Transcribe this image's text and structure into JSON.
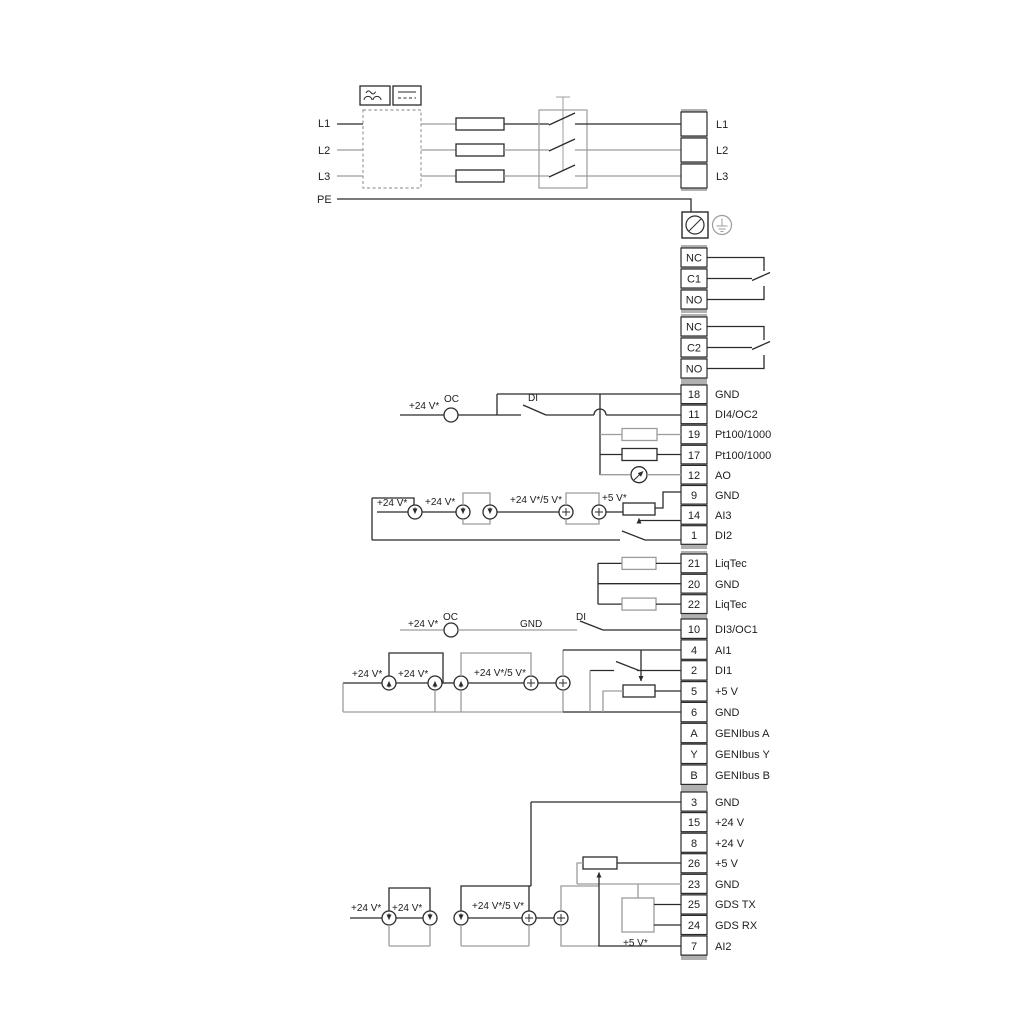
{
  "colors": {
    "wire_black": "#2b2b2b",
    "wire_gray": "#9c9c9c"
  },
  "power": {
    "inputs": [
      "L1",
      "L2",
      "L3"
    ],
    "pe": "PE",
    "outputs": [
      "L1",
      "L2",
      "L3"
    ]
  },
  "relay1": {
    "terminals": [
      "NC",
      "C1",
      "NO"
    ]
  },
  "relay2": {
    "terminals": [
      "NC",
      "C2",
      "NO"
    ]
  },
  "io1": {
    "terminals": [
      {
        "pin": "18",
        "label": "GND"
      },
      {
        "pin": "11",
        "label": "DI4/OC2"
      },
      {
        "pin": "19",
        "label": "Pt100/1000"
      },
      {
        "pin": "17",
        "label": "Pt100/1000"
      },
      {
        "pin": "12",
        "label": "AO"
      },
      {
        "pin": "9",
        "label": "GND"
      },
      {
        "pin": "14",
        "label": "AI3"
      },
      {
        "pin": "1",
        "label": "DI2"
      }
    ]
  },
  "io2": {
    "terminals": [
      {
        "pin": "21",
        "label": "LiqTec"
      },
      {
        "pin": "20",
        "label": "GND"
      },
      {
        "pin": "22",
        "label": "LiqTec"
      }
    ]
  },
  "io3": {
    "terminals": [
      {
        "pin": "10",
        "label": "DI3/OC1"
      },
      {
        "pin": "4",
        "label": "AI1"
      },
      {
        "pin": "2",
        "label": "DI1"
      },
      {
        "pin": "5",
        "label": "+5 V"
      },
      {
        "pin": "6",
        "label": "GND"
      },
      {
        "pin": "A",
        "label": "GENIbus A"
      },
      {
        "pin": "Y",
        "label": "GENIbus Y"
      },
      {
        "pin": "B",
        "label": "GENIbus B"
      }
    ]
  },
  "io4": {
    "terminals": [
      {
        "pin": "3",
        "label": "GND"
      },
      {
        "pin": "15",
        "label": "+24 V"
      },
      {
        "pin": "8",
        "label": "+24 V"
      },
      {
        "pin": "26",
        "label": "+5 V"
      },
      {
        "pin": "23",
        "label": "GND"
      },
      {
        "pin": "25",
        "label": "GDS TX"
      },
      {
        "pin": "24",
        "label": "GDS RX"
      },
      {
        "pin": "7",
        "label": "AI2"
      }
    ]
  },
  "ann": {
    "di4_row": {
      "v24": "+24 V*",
      "oc": "OC",
      "di": "DI"
    },
    "ai3_row": {
      "v24a": "+24 V*",
      "v24b": "+24 V*",
      "v245": "+24 V*/5 V*",
      "v5": "+5 V*"
    },
    "di3_row": {
      "v24": "+24 V*",
      "oc": "OC",
      "gnd": "GND",
      "di": "DI"
    },
    "ai1_row": {
      "v24a": "+24 V*",
      "v24b": "+24 V*",
      "v245": "+24 V*/5 V*"
    },
    "ai2_row": {
      "v24a": "+24 V*",
      "v24b": "+24 V*",
      "v245": "+24 V*/5 V*",
      "v5": "+5 V*"
    }
  }
}
